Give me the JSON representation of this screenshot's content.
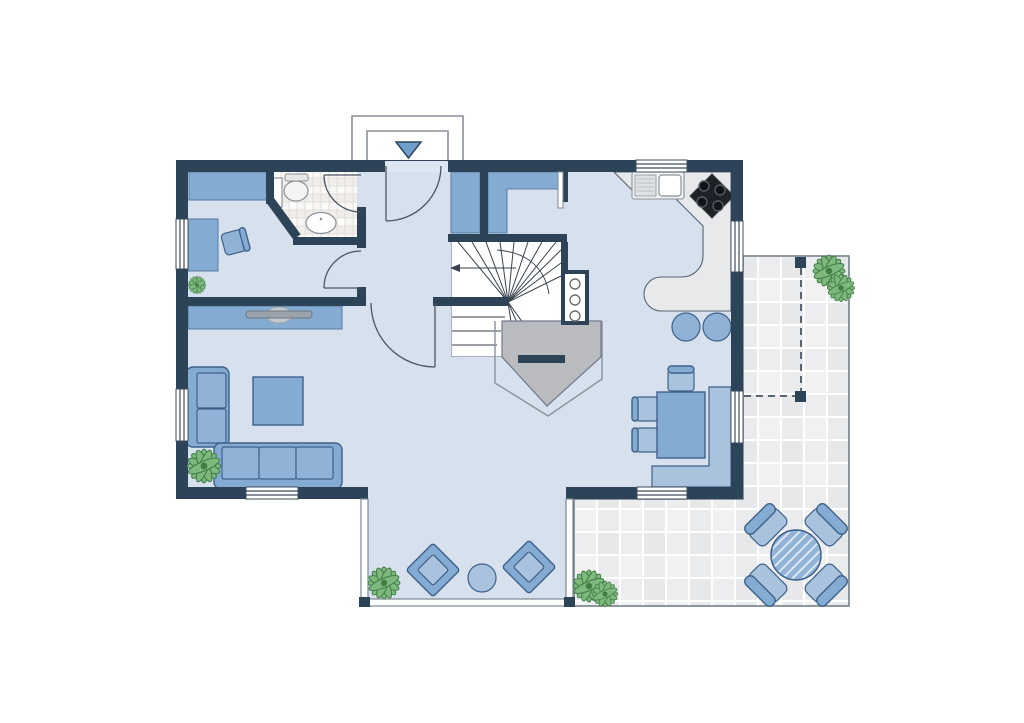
{
  "document": {
    "kind": "architectural-floor-plan",
    "view": "top-down",
    "visible_text": "none"
  },
  "colors": {
    "background": "#ffffff",
    "wall": "#2d4458",
    "floor": "#d7e1ee",
    "floor_light": "#dde7f3",
    "furniture": "#84abd2",
    "furniture_mid": "#8fb2d6",
    "furniture_light": "#a9c3df",
    "furniture_stroke": "#3f6189",
    "soft_stroke": "#5d82a8",
    "counter": "#e7e9eb",
    "counter_edge": "#566270",
    "appliance": "#1e2227",
    "appliance_ring": "#565b63",
    "fixture_stroke": "#8a9199",
    "stair_line": "#39424e",
    "door_line": "#4a5563",
    "window_frame": "#3c4d5e",
    "glass_frame": "#7c8692",
    "porch_line": "#8a9199",
    "dashed_line": "#5a6672",
    "terrace_edge": "#6b7684",
    "tile_a": "#ededef",
    "tile_b": "#e7e8ea",
    "tile_c": "#f1f1f2",
    "tile_d": "#eaebec",
    "btile_a": "#fcfcfb",
    "btile_b": "#f2eeea",
    "btile_c": "#f8f7f5",
    "btile_d": "#efece9",
    "btile_line": "#e2dfda",
    "plant": "#7db87d",
    "plant_dark": "#417c47",
    "fireplace": "#b9bbbe",
    "fireplace_edge": "#70798a",
    "tv": "#9aa3ab",
    "tv_light": "#c3c9cf",
    "arrow": "#6f9fca",
    "hatch": "#dce6f0"
  },
  "rooms": [
    {
      "name": "entrance-hall",
      "features": [
        "front-door",
        "entrance-arrow",
        "porch",
        "wardrobe",
        "hall-door-to-living"
      ]
    },
    {
      "name": "office",
      "features": [
        "sideboard",
        "desk",
        "desk-chair",
        "plant",
        "window"
      ]
    },
    {
      "name": "bathroom",
      "features": [
        "toilet",
        "washbasin",
        "radiator",
        "tiled-floor",
        "door"
      ]
    },
    {
      "name": "closet-nook",
      "features": [
        "built-in-closet",
        "door-to-kitchen"
      ]
    },
    {
      "name": "kitchen",
      "features": [
        "l-shaped-counter",
        "double-sink",
        "cooktop",
        "bar-peninsula",
        "stool",
        "stool",
        "window",
        "window"
      ]
    },
    {
      "name": "staircase",
      "features": [
        "winder-stairs",
        "direction-arrow",
        "walking-line"
      ]
    },
    {
      "name": "fireplace-core",
      "features": [
        "chimney-flue",
        "fireplace-body",
        "hearth-outline"
      ]
    },
    {
      "name": "living-room",
      "features": [
        "tv-sideboard",
        "tv",
        "two-seat-sofa",
        "three-seat-sofa",
        "coffee-table",
        "plant",
        "window",
        "window"
      ]
    },
    {
      "name": "dining-area",
      "features": [
        "dining-table",
        "corner-bench",
        "chair",
        "chair",
        "chair",
        "window",
        "terrace-window"
      ]
    },
    {
      "name": "conservatory",
      "features": [
        "glass-walls",
        "lounge-chair",
        "lounge-chair",
        "side-table",
        "plant"
      ]
    },
    {
      "name": "terrace",
      "features": [
        "tiled-paving",
        "round-table",
        "chair",
        "chair",
        "chair",
        "chair",
        "pergola-dashed-outline",
        "pergola-post",
        "pergola-post",
        "plant-cluster",
        "plant-cluster"
      ]
    }
  ]
}
